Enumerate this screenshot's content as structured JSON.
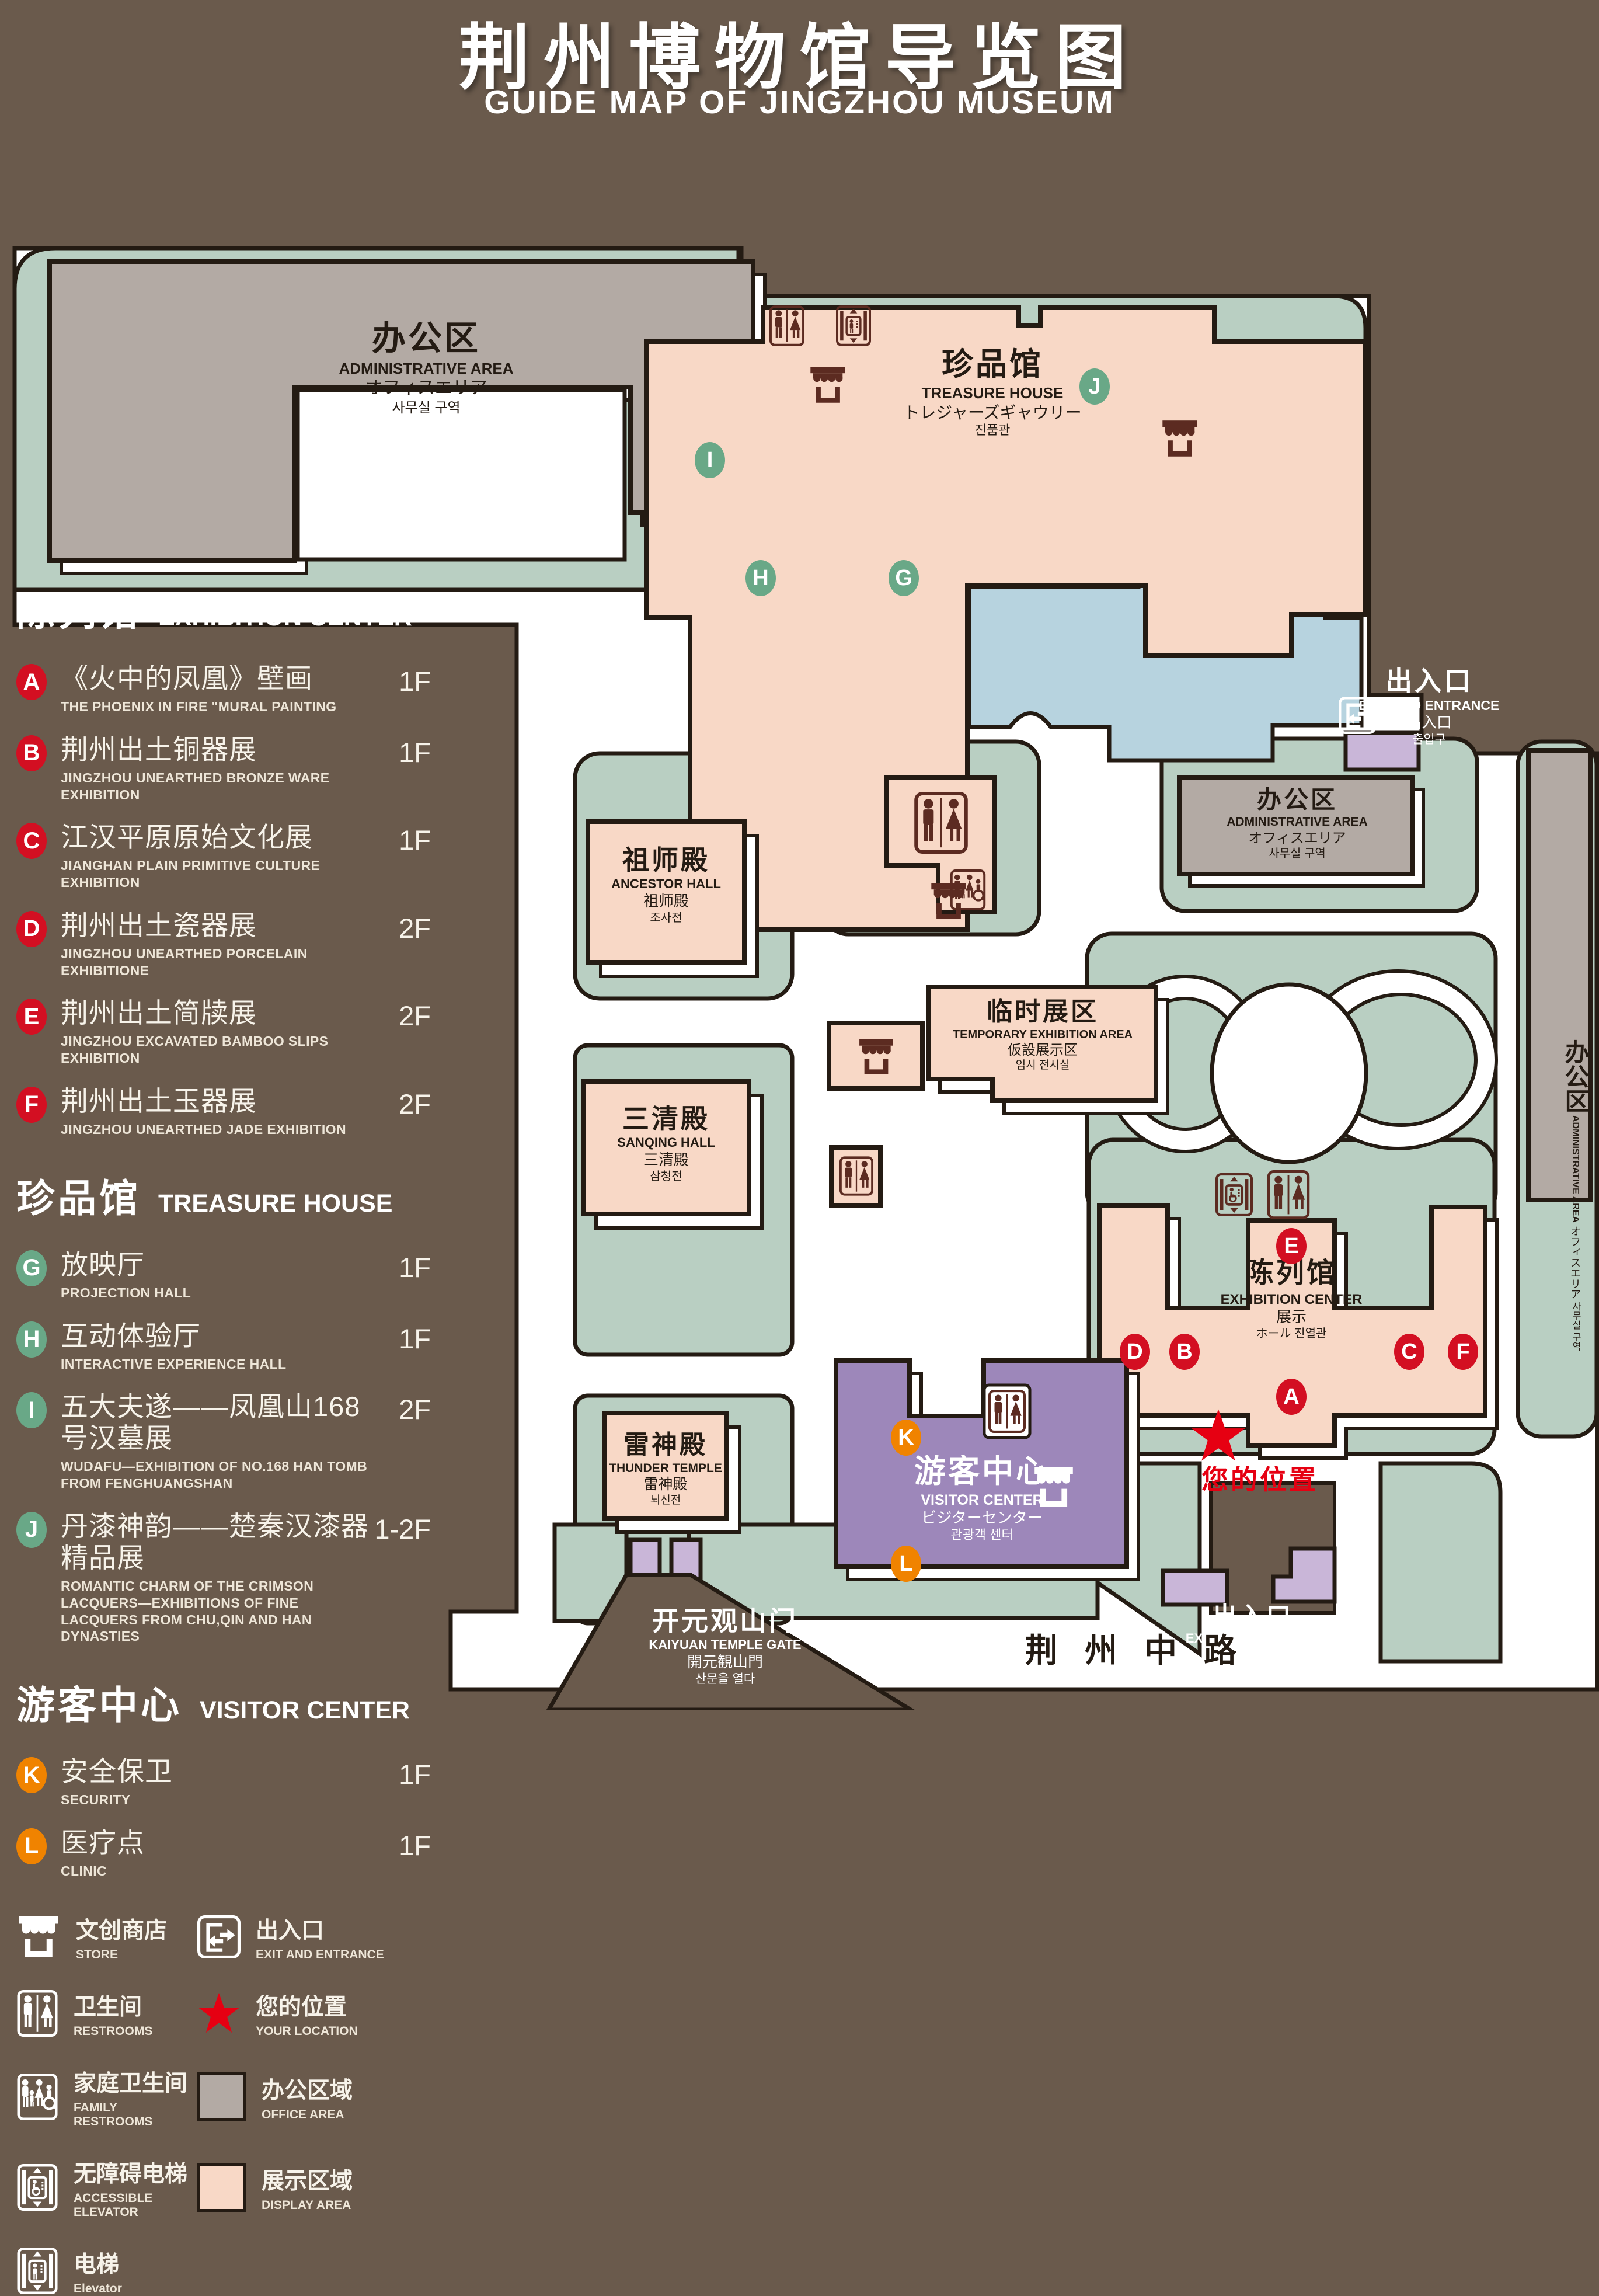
{
  "title": {
    "zh": "荆州博物馆导览图",
    "en": "GUIDE MAP OF JINGZHOU MUSEUM"
  },
  "colors": {
    "badge_red": "#d30f22",
    "badge_green": "#69a887",
    "badge_orange": "#f08300",
    "star_red": "#e60012",
    "office_area": "#b3aaa4",
    "display_area": "#f8d8c6",
    "purple_building": "#9d87ba",
    "lake_blue": "#b7d3df",
    "campus_green": "#b9cfc2"
  },
  "legend": {
    "sections": [
      {
        "zh": "陈列馆",
        "en": "EXHIBITION CENTER",
        "badge_color": "#d30f22",
        "items": [
          {
            "key": "A",
            "zh": "《火中的凤凰》壁画",
            "en": "THE PHOENIX IN FIRE \"MURAL PAINTING",
            "floor": "1F"
          },
          {
            "key": "B",
            "zh": "荆州出土铜器展",
            "en": "JINGZHOU UNEARTHED BRONZE WARE EXHIBITION",
            "floor": "1F"
          },
          {
            "key": "C",
            "zh": "江汉平原原始文化展",
            "en": "JIANGHAN PLAIN PRIMITIVE CULTURE EXHIBITION",
            "floor": "1F"
          },
          {
            "key": "D",
            "zh": "荆州出土瓷器展",
            "en": "JINGZHOU UNEARTHED PORCELAIN EXHIBITIONE",
            "floor": "2F"
          },
          {
            "key": "E",
            "zh": "荆州出土简牍展",
            "en": "JINGZHOU EXCAVATED BAMBOO SLIPS EXHIBITION",
            "floor": "2F"
          },
          {
            "key": "F",
            "zh": "荆州出土玉器展",
            "en": "JINGZHOU UNEARTHED JADE EXHIBITION",
            "floor": "2F"
          }
        ]
      },
      {
        "zh": "珍品馆",
        "en": "TREASURE HOUSE",
        "badge_color": "#69a887",
        "items": [
          {
            "key": "G",
            "zh": "放映厅",
            "en": "PROJECTION HALL",
            "floor": "1F"
          },
          {
            "key": "H",
            "zh": "互动体验厅",
            "en": "INTERACTIVE EXPERIENCE HALL",
            "floor": "1F"
          },
          {
            "key": "I",
            "zh": "五大夫遂——凤凰山168号汉墓展",
            "en": "WUDAFU—EXHIBITION OF NO.168 HAN TOMB FROM FENGHUANGSHAN",
            "floor": "2F"
          },
          {
            "key": "J",
            "zh": "丹漆神韵——楚秦汉漆器精品展",
            "en": "ROMANTIC CHARM OF THE CRIMSON LACQUERS—EXHIBITIONS OF FINE LACQUERS FROM CHU,QIN AND HAN DYNASTIES",
            "floor": "1-2F"
          }
        ]
      },
      {
        "zh": "游客中心",
        "en": "VISITOR CENTER",
        "badge_color": "#f08300",
        "items": [
          {
            "key": "K",
            "zh": "安全保卫",
            "en": "SECURITY",
            "floor": "1F"
          },
          {
            "key": "L",
            "zh": "医疗点",
            "en": "CLINIC",
            "floor": "1F"
          }
        ]
      }
    ],
    "symbols": [
      {
        "type": "icon",
        "sym": "sym-store",
        "name": "store-icon",
        "zh": "文创商店",
        "en": "STORE"
      },
      {
        "type": "icon",
        "sym": "sym-exit",
        "name": "exit-icon",
        "zh": "出入口",
        "en": "EXIT AND ENTRANCE"
      },
      {
        "type": "icon",
        "sym": "sym-restrooms",
        "name": "restrooms-icon",
        "zh": "卫生间",
        "en": "RESTROOMS"
      },
      {
        "type": "icon",
        "sym": "sym-star",
        "name": "location-star-icon",
        "color": "#e60012",
        "zh": "您的位置",
        "en": "YOUR LOCATION"
      },
      {
        "type": "icon",
        "sym": "sym-family",
        "name": "family-restrooms-icon",
        "zh": "家庭卫生间",
        "en": "FAMILY RESTROOMS"
      },
      {
        "type": "swatch",
        "name": "office-area-swatch",
        "color": "#b3aaa4",
        "zh": "办公区域",
        "en": "OFFICE AREA"
      },
      {
        "type": "icon",
        "sym": "sym-acc-elevator",
        "name": "accessible-elevator-icon",
        "zh": "无障碍电梯",
        "en": "ACCESSIBLE ELEVATOR"
      },
      {
        "type": "swatch",
        "name": "display-area-swatch",
        "color": "#f8d8c6",
        "zh": "展示区域",
        "en": "DISPLAY AREA"
      },
      {
        "type": "icon",
        "sym": "sym-elevator",
        "name": "elevator-icon",
        "zh": "电梯",
        "en": "Elevator"
      }
    ]
  },
  "map": {
    "labels": {
      "admin_top_left": {
        "zh": "办公区",
        "en": "ADMINISTRATIVE AREA",
        "ja": "オフィスエリア",
        "ko": "사무실 구역"
      },
      "treasure_house": {
        "zh": "珍品馆",
        "en": "TREASURE HOUSE",
        "ja": "トレジャーズギャウリー",
        "ko": "진품관"
      },
      "exit_right": {
        "zh": "出入口",
        "en": "EXIT AND ENTRANCE",
        "ja": "出入口",
        "ko": "출입구"
      },
      "admin_right": {
        "zh": "办公区",
        "en": "ADMINISTRATIVE AREA",
        "ja": "オフィスエリア",
        "ko": "사무실 구역"
      },
      "admin_far_right": {
        "zh": "办公区",
        "en": "ADMINISTRATIVE AREA",
        "ja": "オフィスエリア",
        "ko": "사무실 구역"
      },
      "ancestor_hall": {
        "zh": "祖师殿",
        "en": "ANCESTOR HALL",
        "ja": "祖师殿",
        "ko": "조사전"
      },
      "temporary_exhibition": {
        "zh": "临时展区",
        "en": "TEMPORARY EXHIBITION AREA",
        "ja": "仮設展示区",
        "ko": "임시 전시실"
      },
      "sanqing_hall": {
        "zh": "三清殿",
        "en": "SANQING HALL",
        "ja": "三清殿",
        "ko": "삼청전"
      },
      "thunder_temple": {
        "zh": "雷神殿",
        "en": "THUNDER TEMPLE",
        "ja": "雷神殿",
        "ko": "뇌신전"
      },
      "visitor_center": {
        "zh": "游客中心",
        "en": "VISITOR CENTER",
        "ja": "ビジターセンター",
        "ko": "관광객 센터"
      },
      "exhibition_center": {
        "zh": "陈列馆",
        "en": "EXHIBITION CENTER",
        "ja": "展示",
        "ko": "ホール 진열관"
      },
      "gate": {
        "zh": "开元观山门",
        "en": "KAIYUAN TEMPLE GATE",
        "ja": "開元観山門",
        "ko": "산문을 열다"
      },
      "exit_bottom": {
        "zh": "出入口",
        "en": "EXIT AND ENTRANCE",
        "ja": "出入口",
        "ko": "출입구"
      },
      "road": "荆州中路",
      "your_location": "您的位置"
    },
    "marker_letters": {
      "A": "A",
      "B": "B",
      "C": "C",
      "D": "D",
      "E": "E",
      "F": "F",
      "G": "G",
      "H": "H",
      "I": "I",
      "J": "J",
      "K": "K",
      "L": "L"
    }
  }
}
